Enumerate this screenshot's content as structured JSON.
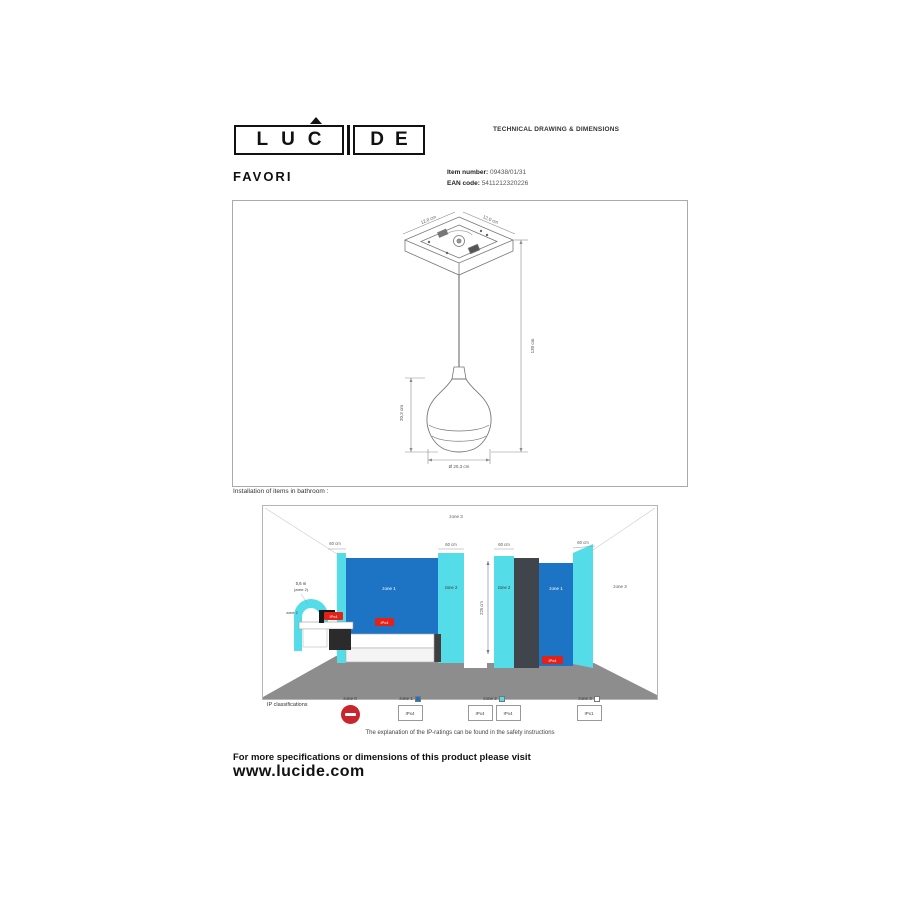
{
  "header": {
    "logo_left": "LUC",
    "logo_right": "DE",
    "doc_title": "TECHNICAL DRAWING & DIMENSIONS"
  },
  "product": {
    "name": "FAVORI",
    "item_label": "Item number:",
    "item_value": "09438/01/31",
    "ean_label": "EAN code:",
    "ean_value": "5411212320226"
  },
  "drawing": {
    "canopy_width": "12,0 cm",
    "canopy_depth": "12,0 cm",
    "total_height": "130 cm",
    "shade_height": "20,3 cm",
    "shade_diameter": "Ø 20,3 cm"
  },
  "bathroom": {
    "section_title": "Installation of items in bathroom :",
    "zone3_top": "zone 3",
    "dims": [
      "60 cm",
      "60 cm",
      "60 cm",
      "60 cm"
    ],
    "basin_radius": "0,6 m",
    "basin_radius_sub": "(zone 2)",
    "basin_zone": "zone 2",
    "tub_zone1": "zone 1",
    "tub_zone2": "zone 2",
    "room_height": "225 cm",
    "shower_zone2": "zone 2",
    "shower_zone1": "zone 1",
    "zone3_right": "zone 3",
    "ip_badge": "IPx4"
  },
  "legend": {
    "title": "IP classifications",
    "zone0_label": "zone 0",
    "zone0_icon": "no-entry",
    "zone1_label": "zone 1",
    "zone1_boxes": [
      "IPx4"
    ],
    "zone2_label": "zone 2",
    "zone2_boxes": [
      "IPx4",
      "IPx4"
    ],
    "zone3_label": "zone 3",
    "zone3_boxes": [
      "IPx1"
    ],
    "note": "The explanation of the IP-ratings can be found in the safety instructions"
  },
  "footer": {
    "line1": "For more specifications or dimensions of this product please visit",
    "line2": "www.lucide.com"
  },
  "colors": {
    "zone1_blue": "#1d74c4",
    "zone2_cyan": "#54dde9",
    "floor_gray": "#8d8d8d",
    "badge_red": "#e32119",
    "noentry_red": "#c9252c"
  }
}
